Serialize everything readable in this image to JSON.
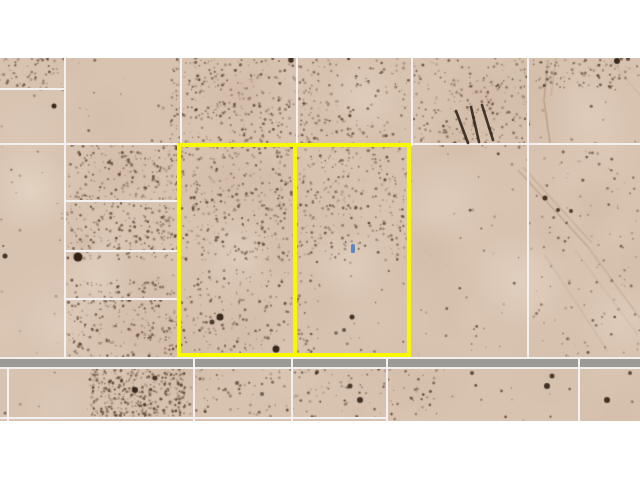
{
  "scene": {
    "description": "Aerial satellite view of desert land parcels with two adjacent lots outlined in yellow, a gray road along the bottom, white parcel boundary lines, scattered dark brush, and white letterbox bands top and bottom",
    "colors": {
      "page_background": "#ffffff",
      "terrain_base": "#d8c3b0",
      "terrain_light": "#ece0d2",
      "terrain_dark": "#ba9e84",
      "speckle_brown": "#4a3220",
      "boundary_white": "#f2f0f0",
      "highlight_yellow": "#f8f800",
      "road_gray": "#9c9a94",
      "road_edge": "#f2f0ee",
      "marker_blue": "#5c87c9",
      "shadow_dark": "#2e2118"
    }
  },
  "map": {
    "top": 58,
    "bottom": 421,
    "width": 640,
    "road": {
      "y": 357,
      "height": 12
    },
    "boundary_lines": {
      "horizontal": [
        {
          "x1": 0,
          "x2": 65,
          "y": 88
        },
        {
          "x1": 0,
          "x2": 640,
          "y": 143
        },
        {
          "x1": 64,
          "x2": 180,
          "y": 200
        },
        {
          "x1": 64,
          "x2": 180,
          "y": 250
        },
        {
          "x1": 64,
          "x2": 180,
          "y": 298
        },
        {
          "x1": 0,
          "x2": 386,
          "y": 417
        }
      ],
      "vertical": [
        {
          "x": 64,
          "y1": 58,
          "y2": 358
        },
        {
          "x": 180,
          "y1": 58,
          "y2": 146
        },
        {
          "x": 296,
          "y1": 58,
          "y2": 146
        },
        {
          "x": 411,
          "y1": 58,
          "y2": 146
        },
        {
          "x": 527,
          "y1": 58,
          "y2": 358
        },
        {
          "x": 7,
          "y1": 368,
          "y2": 421
        },
        {
          "x": 193,
          "y1": 357,
          "y2": 421
        },
        {
          "x": 291,
          "y1": 357,
          "y2": 421
        },
        {
          "x": 386,
          "y1": 357,
          "y2": 421
        },
        {
          "x": 578,
          "y1": 357,
          "y2": 421
        }
      ]
    },
    "highlighted_parcels": [
      {
        "label": "west-lot",
        "x": 177,
        "y": 143,
        "w": 120,
        "h": 214
      },
      {
        "label": "east-lot",
        "x": 293,
        "y": 143,
        "w": 118,
        "h": 214
      }
    ],
    "marker": {
      "x": 351,
      "y": 244,
      "w": 4,
      "h": 9
    },
    "pole_shadows": {
      "x": 448,
      "y": 101,
      "w": 50,
      "h": 48,
      "strokes": [
        [
          8,
          10,
          20,
          42
        ],
        [
          23,
          6,
          31,
          41
        ],
        [
          34,
          4,
          45,
          39
        ]
      ]
    },
    "dark_spots": [
      {
        "x": 54,
        "y": 106,
        "r": 2.5,
        "a": 0.9
      },
      {
        "x": 291,
        "y": 60,
        "r": 2.8,
        "a": 0.85
      },
      {
        "x": 350,
        "y": 116,
        "r": 1.5,
        "a": 0.55
      },
      {
        "x": 617,
        "y": 61,
        "r": 3,
        "a": 0.9
      },
      {
        "x": 628,
        "y": 59,
        "r": 2,
        "a": 0.7
      },
      {
        "x": 5,
        "y": 256,
        "r": 2.5,
        "a": 0.85
      },
      {
        "x": 78,
        "y": 257,
        "r": 4.5,
        "a": 0.95
      },
      {
        "x": 220,
        "y": 317,
        "r": 3.5,
        "a": 0.9
      },
      {
        "x": 212,
        "y": 322,
        "r": 2.5,
        "a": 0.8
      },
      {
        "x": 276,
        "y": 349,
        "r": 3.5,
        "a": 0.92
      },
      {
        "x": 268,
        "y": 338,
        "r": 1.8,
        "a": 0.5
      },
      {
        "x": 352,
        "y": 317,
        "r": 2.5,
        "a": 0.85
      },
      {
        "x": 344,
        "y": 330,
        "r": 2,
        "a": 0.65
      },
      {
        "x": 336,
        "y": 333,
        "r": 1.8,
        "a": 0.55
      },
      {
        "x": 545,
        "y": 198,
        "r": 2.5,
        "a": 0.85
      },
      {
        "x": 558,
        "y": 210,
        "r": 2,
        "a": 0.8
      },
      {
        "x": 571,
        "y": 211,
        "r": 2,
        "a": 0.8
      },
      {
        "x": 317,
        "y": 372,
        "r": 2,
        "a": 0.7
      },
      {
        "x": 350,
        "y": 386,
        "r": 2.5,
        "a": 0.8
      },
      {
        "x": 360,
        "y": 400,
        "r": 3,
        "a": 0.85
      },
      {
        "x": 472,
        "y": 373,
        "r": 2,
        "a": 0.7
      },
      {
        "x": 237,
        "y": 383,
        "r": 2,
        "a": 0.6
      },
      {
        "x": 262,
        "y": 394,
        "r": 2,
        "a": 0.6
      },
      {
        "x": 552,
        "y": 376,
        "r": 2.5,
        "a": 0.8
      },
      {
        "x": 547,
        "y": 386,
        "r": 3,
        "a": 0.85
      },
      {
        "x": 607,
        "y": 400,
        "r": 3,
        "a": 0.85
      },
      {
        "x": 630,
        "y": 373,
        "r": 2,
        "a": 0.7
      },
      {
        "x": 135,
        "y": 390,
        "r": 3,
        "a": 0.9
      },
      {
        "x": 155,
        "y": 378,
        "r": 2.5,
        "a": 0.8
      }
    ]
  }
}
